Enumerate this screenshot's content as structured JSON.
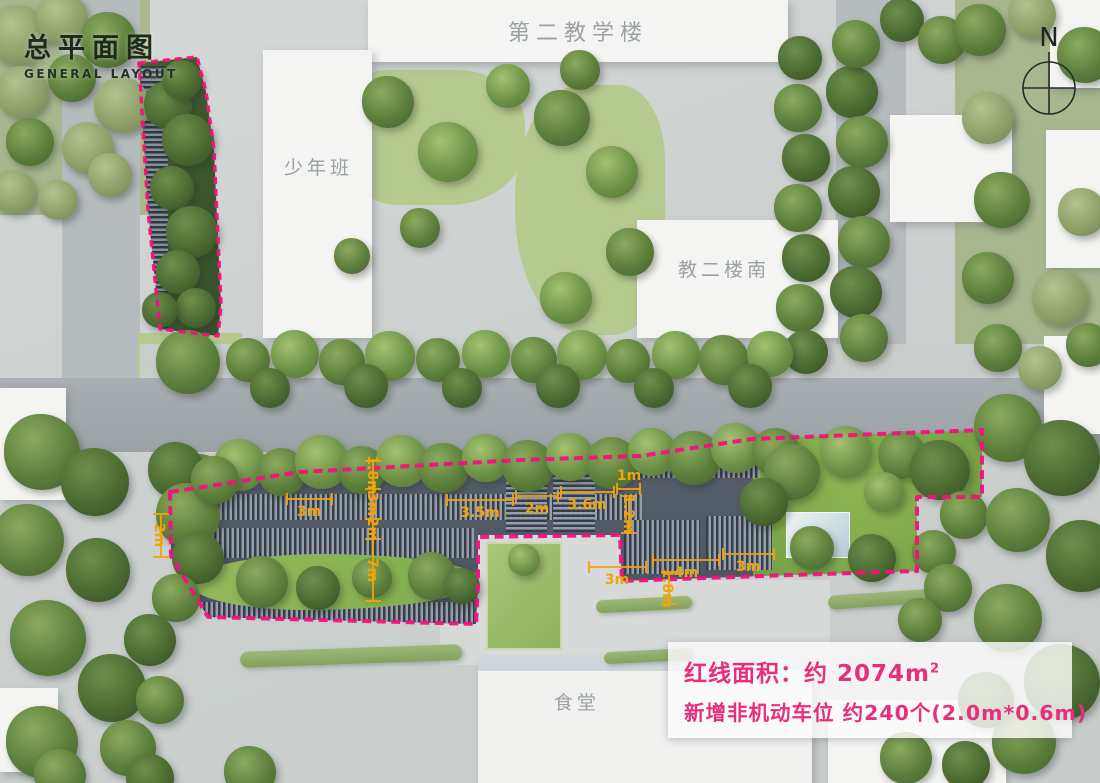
{
  "title": {
    "zh": "总平面图",
    "en": "GENERAL LAYOUT"
  },
  "compass": {
    "label": "N"
  },
  "buildings": {
    "teaching2": "第二教学楼",
    "youth_class": "少年班",
    "teaching2_south": "教二楼南",
    "canteen": "食堂"
  },
  "info_box": {
    "line1": "红线面积：约 2074m",
    "line1_sup": "2",
    "line2": "新增非机动车位 约240个(2.0m*0.6m)"
  },
  "dimensions": {
    "d1": "3m",
    "d2": "1.8m",
    "d3": "3m",
    "d4": "2m",
    "d5": "7m",
    "d6": "3.5m",
    "d7": "2m",
    "d8": "3.6m",
    "d9": "1m",
    "d10": "1.2m",
    "d11": "3m",
    "d12": "4m",
    "d13": "3m",
    "d14": "1.8m",
    "d15": "2m"
  },
  "colors": {
    "boundary": "#f3117e",
    "dimension": "#f2a30a",
    "annotation": "#e82f7e"
  }
}
